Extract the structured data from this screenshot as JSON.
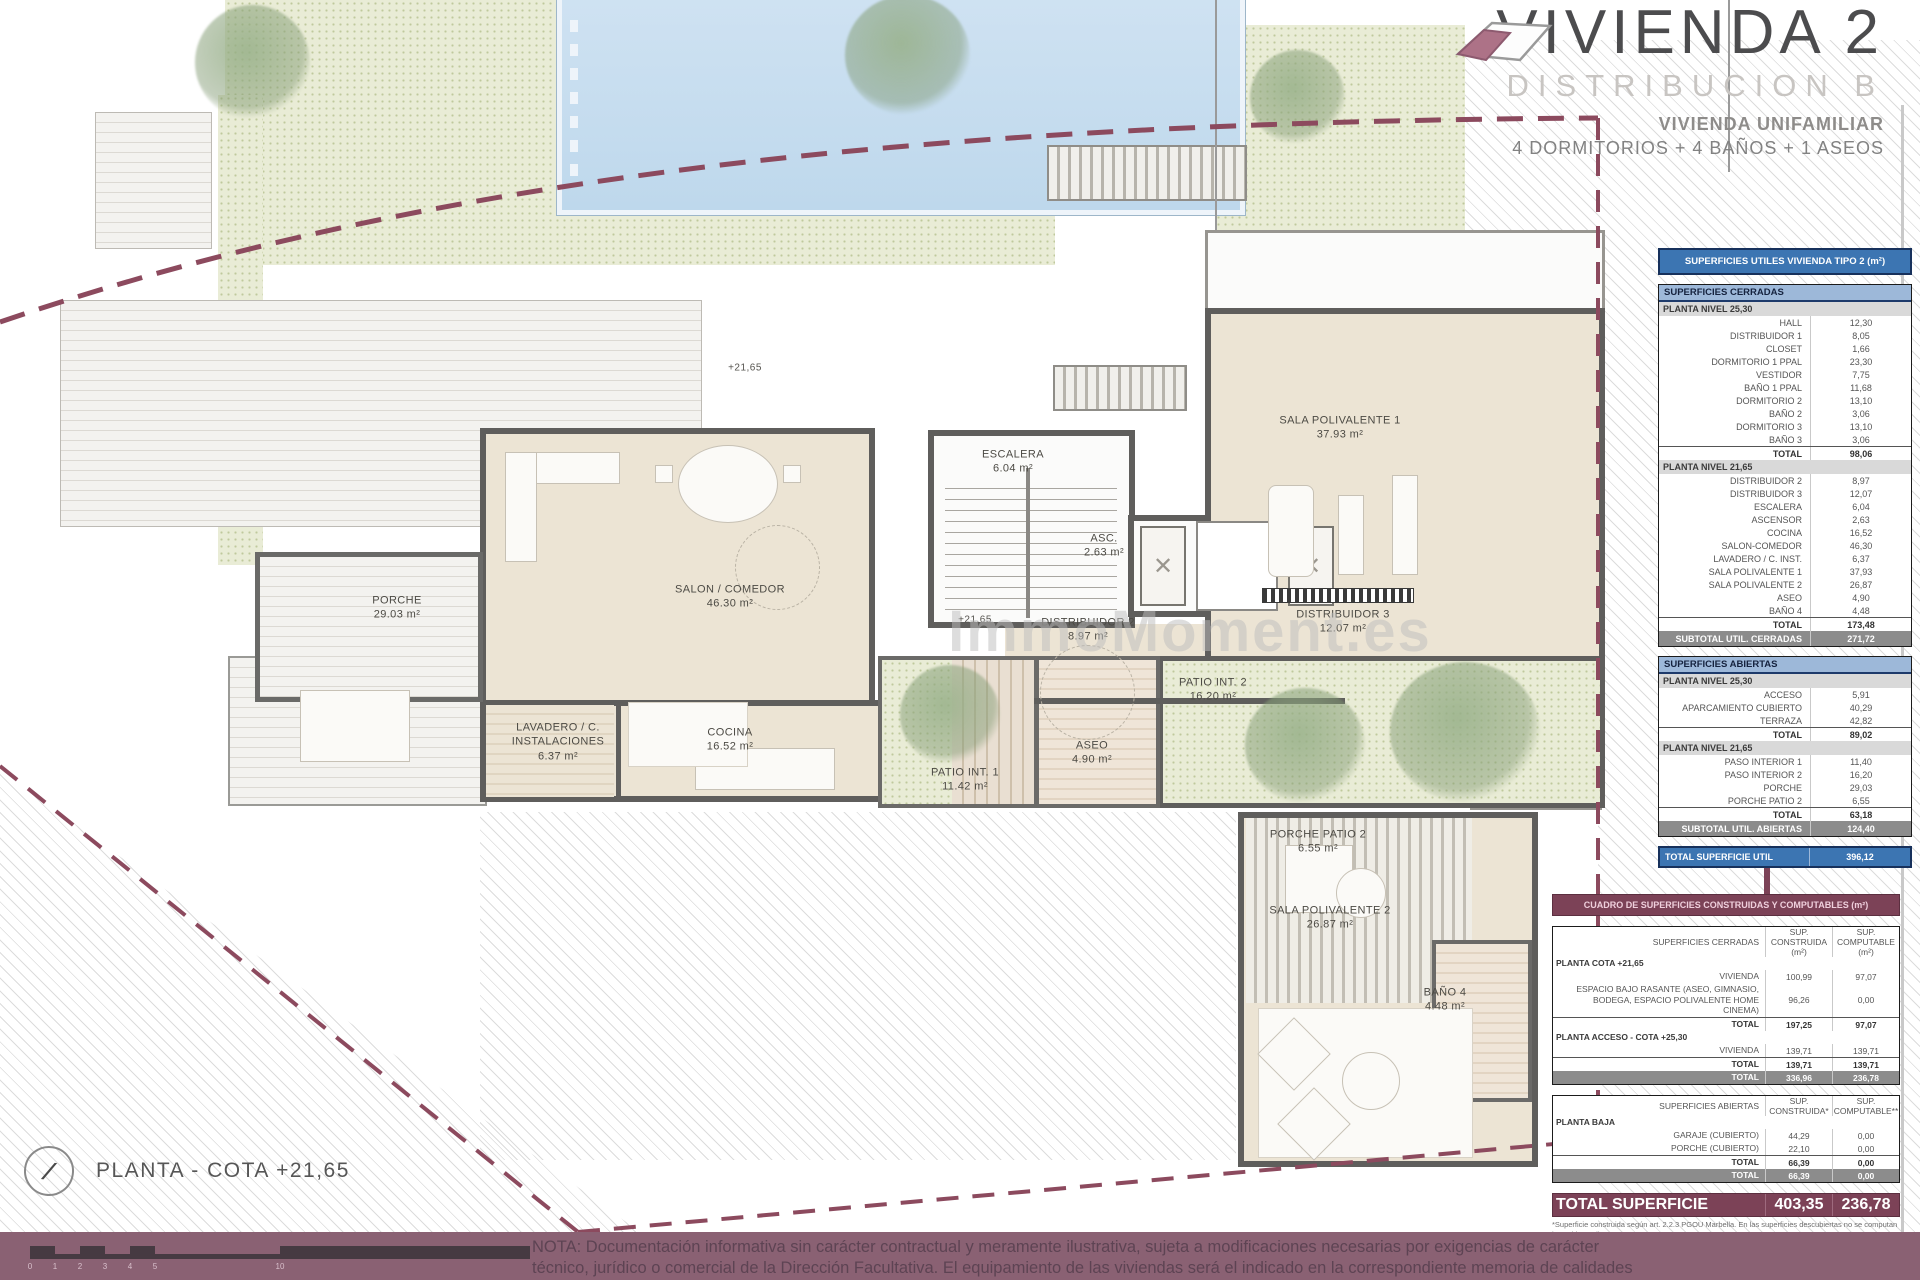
{
  "title_block": {
    "title": "VIVIENDA 2",
    "subtitle": "DISTRIBUCION B",
    "line1": "VIVIENDA UNIFAMILIAR",
    "line2": "4 DORMITORIOS + 4 BAÑOS +  1 ASEOS"
  },
  "watermark": "ImmoMoment.es",
  "caption": {
    "label": "PLANTA - COTA +21,65"
  },
  "colors": {
    "boundary_dash": "#8c4a5e",
    "table_blue": "#3c75b2",
    "table_blue_light": "#9db8d9",
    "maroon": "#7c4257",
    "band_mauve": "#8a6173",
    "wall_gray": "#5f5e5c",
    "room_beige": "#ece4d4",
    "pool_blue": "#cfe2f2",
    "vegetation_green": "#e9ecd6"
  },
  "rooms": [
    {
      "name": "PORCHE",
      "area": "29.03 m²",
      "x": 397,
      "y": 608
    },
    {
      "name": "SALON / COMEDOR",
      "area": "46.30 m²",
      "x": 730,
      "y": 597
    },
    {
      "name": "ESCALERA",
      "area": "6.04 m²",
      "x": 1013,
      "y": 462
    },
    {
      "name": "ASC.",
      "area": "2.63 m²",
      "x": 1104,
      "y": 546
    },
    {
      "name": "DISTRIBUIDOR 2",
      "area": "8.97 m²",
      "x": 1088,
      "y": 630
    },
    {
      "name": "DISTRIBUIDOR 3",
      "area": "12.07 m²",
      "x": 1343,
      "y": 622
    },
    {
      "name": "SALA POLIVALENTE 1",
      "area": "37.93 m²",
      "x": 1340,
      "y": 428
    },
    {
      "name": "PATIO INT. 2",
      "area": "16.20 m²",
      "x": 1213,
      "y": 690
    },
    {
      "name": "ASEO",
      "area": "4.90 m²",
      "x": 1092,
      "y": 753
    },
    {
      "name": "PATIO INT. 1",
      "area": "11.42 m²",
      "x": 965,
      "y": 780,
      "w": 110
    },
    {
      "name": "LAVADERO / C. INSTALACIONES",
      "area": "6.37 m²",
      "x": 558,
      "y": 742,
      "w": 150
    },
    {
      "name": "COCINA",
      "area": "16.52 m²",
      "x": 730,
      "y": 740
    },
    {
      "name": "PORCHE PATIO 2",
      "area": "6.55 m²",
      "x": 1318,
      "y": 842
    },
    {
      "name": "SALA POLIVALENTE 2",
      "area": "26.87 m²",
      "x": 1330,
      "y": 918
    },
    {
      "name": "BAÑO 4",
      "area": "4.48 m²",
      "x": 1445,
      "y": 1000
    },
    {
      "name": "+21,65",
      "area": "",
      "x": 745,
      "y": 368,
      "cls": "level"
    },
    {
      "name": "+21,65",
      "area": "",
      "x": 975,
      "y": 620,
      "cls": "level"
    }
  ],
  "tables": {
    "utiles_title": "SUPERFICIES UTILES VIVIENDA TIPO 2 (m²)",
    "cerradas": {
      "header": "SUPERFICIES CERRADAS",
      "rows": [
        {
          "t": "sub",
          "label": "PLANTA NIVEL 25,30"
        },
        {
          "t": "row",
          "label": "HALL",
          "value": "12,30"
        },
        {
          "t": "row",
          "label": "DISTRIBUIDOR 1",
          "value": "8,05"
        },
        {
          "t": "row",
          "label": "CLOSET",
          "value": "1,66"
        },
        {
          "t": "row",
          "label": "DORMITORIO 1 PPAL",
          "value": "23,30"
        },
        {
          "t": "row",
          "label": "VESTIDOR",
          "value": "7,75"
        },
        {
          "t": "row",
          "label": "BAÑO 1 PPAL",
          "value": "11,68"
        },
        {
          "t": "row",
          "label": "DORMITORIO 2",
          "value": "13,10"
        },
        {
          "t": "row",
          "label": "BAÑO 2",
          "value": "3,06"
        },
        {
          "t": "row",
          "label": "DORMITORIO 3",
          "value": "13,10"
        },
        {
          "t": "row",
          "label": "BAÑO 3",
          "value": "3,06"
        },
        {
          "t": "total",
          "label": "TOTAL",
          "value": "98,06"
        },
        {
          "t": "sub",
          "label": "PLANTA NIVEL 21,65"
        },
        {
          "t": "row",
          "label": "DISTRIBUIDOR 2",
          "value": "8,97"
        },
        {
          "t": "row",
          "label": "DISTRIBUIDOR 3",
          "value": "12,07"
        },
        {
          "t": "row",
          "label": "ESCALERA",
          "value": "6,04"
        },
        {
          "t": "row",
          "label": "ASCENSOR",
          "value": "2,63"
        },
        {
          "t": "row",
          "label": "COCINA",
          "value": "16,52"
        },
        {
          "t": "row",
          "label": "SALON-COMEDOR",
          "value": "46,30"
        },
        {
          "t": "row",
          "label": "LAVADERO / C. INST.",
          "value": "6,37"
        },
        {
          "t": "row",
          "label": "SALA POLIVALENTE 1",
          "value": "37,93"
        },
        {
          "t": "row",
          "label": "SALA POLIVALENTE 2",
          "value": "26,87"
        },
        {
          "t": "row",
          "label": "ASEO",
          "value": "4,90"
        },
        {
          "t": "row",
          "label": "BAÑO 4",
          "value": "4,48"
        },
        {
          "t": "total",
          "label": "TOTAL",
          "value": "173,48"
        },
        {
          "t": "dark",
          "label": "SUBTOTAL UTIL. CERRADAS",
          "value": "271,72"
        }
      ]
    },
    "abiertas": {
      "header": "SUPERFICIES ABIERTAS",
      "rows": [
        {
          "t": "sub",
          "label": "PLANTA NIVEL 25,30"
        },
        {
          "t": "row",
          "label": "ACCESO",
          "value": "5,91"
        },
        {
          "t": "row",
          "label": "APARCAMIENTO CUBIERTO",
          "value": "40,29"
        },
        {
          "t": "row",
          "label": "TERRAZA",
          "value": "42,82"
        },
        {
          "t": "total",
          "label": "TOTAL",
          "value": "89,02"
        },
        {
          "t": "sub",
          "label": "PLANTA NIVEL 21,65"
        },
        {
          "t": "row",
          "label": "PASO INTERIOR 1",
          "value": "11,40"
        },
        {
          "t": "row",
          "label": "PASO INTERIOR 2",
          "value": "16,20"
        },
        {
          "t": "row",
          "label": "PORCHE",
          "value": "29,03"
        },
        {
          "t": "row",
          "label": "PORCHE PATIO 2",
          "value": "6,55"
        },
        {
          "t": "total",
          "label": "TOTAL",
          "value": "63,18"
        },
        {
          "t": "dark",
          "label": "SUBTOTAL UTIL. ABIERTAS",
          "value": "124,40"
        }
      ]
    },
    "total_util": {
      "label": "TOTAL SUPERFICIE UTIL",
      "value": "396,12"
    },
    "cuadro_title": "CUADRO DE SUPERFICIES CONSTRUIDAS Y COMPUTABLES (m²)",
    "construidas_cerradas": {
      "rows": [
        {
          "t": "hd",
          "label": "SUPERFICIES CERRADAS",
          "c1": "SUP. CONSTRUIDA (m²)",
          "c2": "SUP. COMPUTABLE (m²)"
        },
        {
          "t": "sub",
          "label": "PLANTA COTA +21,65"
        },
        {
          "t": "row",
          "label": "VIVIENDA",
          "c1": "100,99",
          "c2": "97,07"
        },
        {
          "t": "row",
          "label": "ESPACIO BAJO RASANTE (ASEO, GIMNASIO, BODEGA, ESPACIO POLIVALENTE HOME CINEMA)",
          "c1": "96,26",
          "c2": "0,00"
        },
        {
          "t": "total",
          "label": "TOTAL",
          "c1": "197,25",
          "c2": "97,07"
        },
        {
          "t": "sub",
          "label": "PLANTA ACCESO - COTA +25,30"
        },
        {
          "t": "row",
          "label": "VIVIENDA",
          "c1": "139,71",
          "c2": "139,71"
        },
        {
          "t": "total",
          "label": "TOTAL",
          "c1": "139,71",
          "c2": "139,71"
        },
        {
          "t": "dark",
          "label": "TOTAL",
          "c1": "336,96",
          "c2": "236,78"
        }
      ]
    },
    "construidas_abiertas": {
      "rows": [
        {
          "t": "hd",
          "label": "SUPERFICIES ABIERTAS",
          "c1": "SUP. CONSTRUIDA*",
          "c2": "SUP. COMPUTABLE**"
        },
        {
          "t": "sub",
          "label": "PLANTA BAJA"
        },
        {
          "t": "row",
          "label": "GARAJE (CUBIERTO)",
          "c1": "44,29",
          "c2": "0,00"
        },
        {
          "t": "row",
          "label": "PORCHE (CUBIERTO)",
          "c1": "22,10",
          "c2": "0,00"
        },
        {
          "t": "total",
          "label": "TOTAL",
          "c1": "66,39",
          "c2": "0,00"
        },
        {
          "t": "dark",
          "label": "TOTAL",
          "c1": "66,39",
          "c2": "0,00"
        }
      ]
    },
    "total_superficie": {
      "label": "TOTAL SUPERFICIE",
      "c1": "403,35",
      "c2": "236,78"
    },
    "footnotes": [
      "*Superficie construida según art. 2.2.3 PGOU Marbella. En las superficies descubiertas no se computan las cubiertas ligeras.",
      "**Superficie construida computable: cerradas más abiertas cubiertas computables al 50%."
    ]
  },
  "scale_bar": {
    "numbers": [
      {
        "n": "0",
        "x": 30
      },
      {
        "n": "1",
        "x": 55
      },
      {
        "n": "2",
        "x": 80
      },
      {
        "n": "3",
        "x": 105
      },
      {
        "n": "4",
        "x": 130
      },
      {
        "n": "5",
        "x": 155
      },
      {
        "n": "10",
        "x": 280
      }
    ]
  },
  "nota": {
    "line1": "NOTA: Documentación informativa sin carácter contractual y meramente ilustrativa, sujeta a modificaciones necesarias por exigencias de carácter",
    "line2": "técnico, jurídico o comercial de la Dirección Facultativa. El equipamiento de las viviendas será el indicado en la correspondiente memoria de calidades"
  }
}
